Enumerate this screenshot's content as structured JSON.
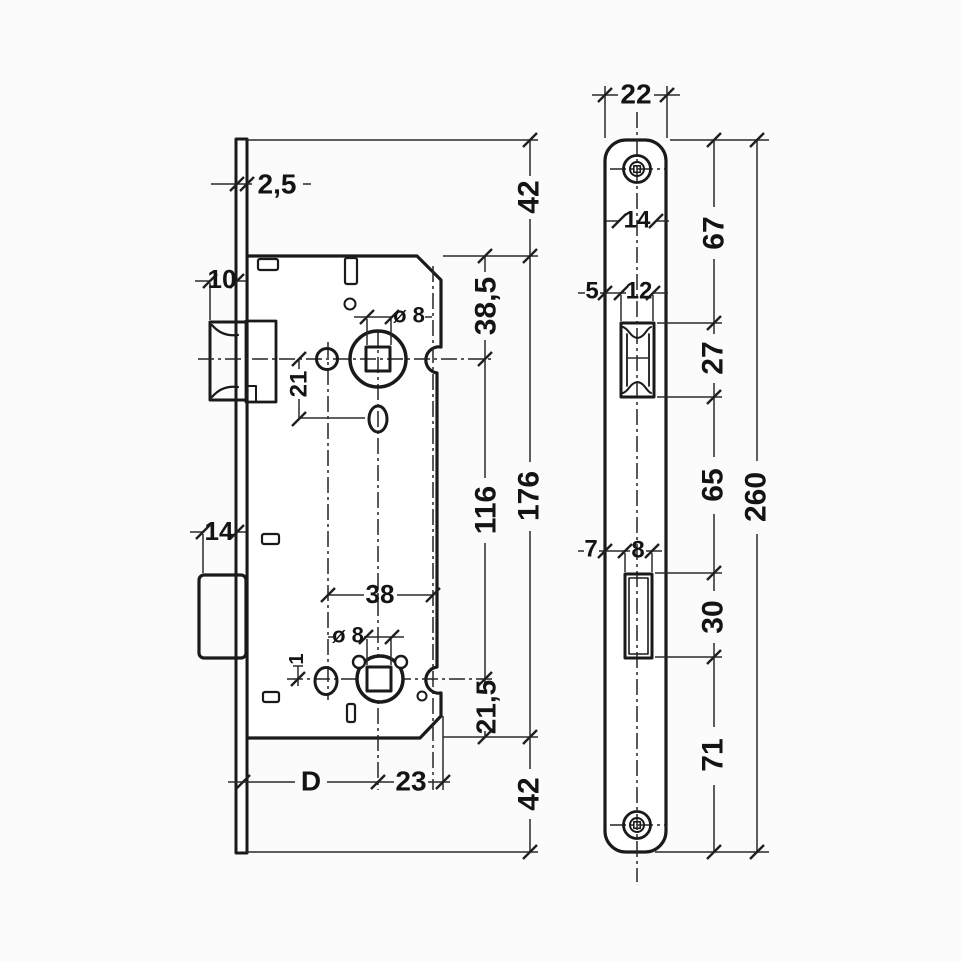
{
  "drawing": {
    "type": "mortise-lock-dimension-drawing",
    "line_color": "#1a1a1a",
    "background": "#fbfbfb",
    "side_view": {
      "faceplate_thickness": "2,5",
      "latch_projection": "10",
      "top_margin": "42",
      "case_top_to_follower_axis": "38,5",
      "follower_axis_spacing": "116",
      "case_height": "176",
      "follower_to_hole_below": "21",
      "upper_spindle_hole": "ø 8",
      "deadbolt_projection": "14",
      "hole_line_spacing": "38",
      "lower_spindle_hole": "ø 8",
      "small_offset": "1",
      "lower_axis_to_case_bottom": "21,5",
      "bottom_margin": "42",
      "backset": "D",
      "axis_to_front_edge": "23"
    },
    "front_view": {
      "plate_width": "22",
      "latch_width": "14",
      "plate_top_to_latch_cutout": "67",
      "edge_margin": "5",
      "latch_cutout_width": "12",
      "latch_cutout_height": "27",
      "latch_to_deadbolt_cutout": "65",
      "plate_height": "260",
      "deadbolt_cutout_margin": "7",
      "deadbolt_cutout_width": "8",
      "deadbolt_cutout_height": "30",
      "deadbolt_cutout_to_bottom": "71"
    }
  }
}
